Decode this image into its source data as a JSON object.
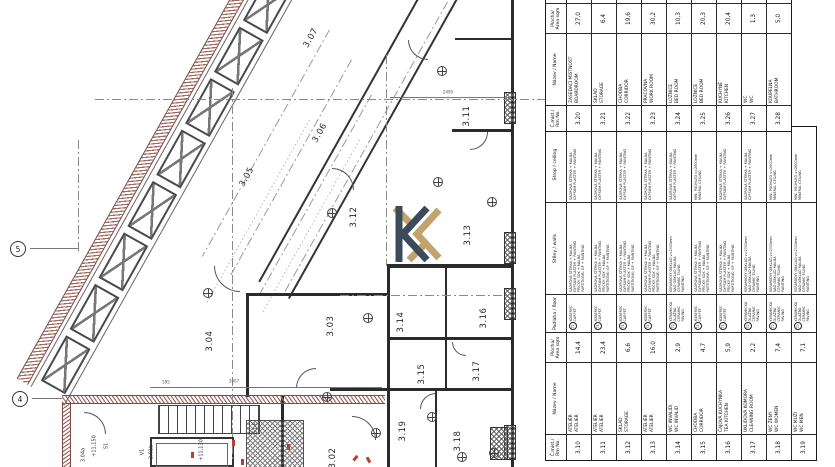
{
  "logo": {
    "navy": "#3c4b59",
    "gold": "#c2a26e"
  },
  "grid_axes": {
    "bubbles": [
      {
        "label": "5"
      },
      {
        "label": "4"
      }
    ]
  },
  "plan": {
    "rooms": [
      {
        "label": "3.02",
        "x": 333,
        "y": 458,
        "rot": -90
      },
      {
        "label": "3.03",
        "x": 331,
        "y": 326,
        "rot": -90
      },
      {
        "label": "3.04",
        "x": 210,
        "y": 341,
        "rot": -90
      },
      {
        "label": "3.05",
        "x": 247,
        "y": 177,
        "rot": -61
      },
      {
        "label": "3.06",
        "x": 320,
        "y": 133,
        "rot": -61
      },
      {
        "label": "3.07",
        "x": 311,
        "y": 38,
        "rot": -61
      },
      {
        "label": "3.11",
        "x": 467,
        "y": 116,
        "rot": -90
      },
      {
        "label": "3.12",
        "x": 354,
        "y": 217,
        "rot": -90
      },
      {
        "label": "3.13",
        "x": 468,
        "y": 235,
        "rot": -90
      },
      {
        "label": "3.14",
        "x": 401,
        "y": 322,
        "rot": -90
      },
      {
        "label": "3.15",
        "x": 422,
        "y": 374,
        "rot": -90
      },
      {
        "label": "3.16",
        "x": 484,
        "y": 318,
        "rot": -90
      },
      {
        "label": "3.17",
        "x": 477,
        "y": 371,
        "rot": -90
      },
      {
        "label": "3.18",
        "x": 458,
        "y": 441,
        "rot": -90
      },
      {
        "label": "3.19",
        "x": 403,
        "y": 431,
        "rot": -90
      }
    ],
    "annotations": [
      {
        "label": "S1",
        "x": 107,
        "y": 446,
        "rot": -90
      },
      {
        "label": "+11,150",
        "x": 95,
        "y": 446,
        "rot": -90
      },
      {
        "label": "V1",
        "x": 143,
        "y": 452,
        "rot": -90
      },
      {
        "label": "3.01b",
        "x": 152,
        "y": 452,
        "rot": -90
      },
      {
        "label": "+11,130",
        "x": 202,
        "y": 450,
        "rot": -90
      },
      {
        "label": "S1-P",
        "x": 256,
        "y": 428,
        "rot": -90
      },
      {
        "label": "3.04a",
        "x": 84,
        "y": 455,
        "rot": -90
      }
    ],
    "dimensions": [
      {
        "label": "595",
        "x": 166,
        "y": 382
      },
      {
        "label": "3007",
        "x": 234,
        "y": 381
      },
      {
        "label": "2490",
        "x": 448,
        "y": 92
      }
    ]
  },
  "schedule": {
    "headers": {
      "rm": "Č.míst./\nRm No.",
      "name": "Název / Name",
      "area": "Plocha/\nArea sqm",
      "floor": "Podlaha / floor",
      "walls": "Stěny / walls",
      "ceil": "Strop / ceiling",
      "sliver": ""
    },
    "table1": {
      "rooms": [
        {
          "no": "3.10",
          "cz": "ATELIÉR",
          "en": "ATELIER",
          "area": "14,4",
          "floor": {
            "sym": "T1",
            "cz": "KOBEREC",
            "en": "CARPET"
          },
          "walls": [
            "SÁDROVÁ STĚRKA + MALBA",
            "GYPSUM PLASTER + PAINTING",
            "PŘÍČKY: SDK + MALBA",
            "PARTITIONS: GP + PAINTING"
          ],
          "ceil": [
            "SÁDROVÁ STĚRKA + MALBA",
            "GYPSUM PLASTER + PAINTING"
          ]
        },
        {
          "no": "3.11",
          "cz": "ATELIÉR",
          "en": "ATELIER",
          "area": "23,4",
          "floor": {
            "sym": "T1",
            "cz": "KOBEREC",
            "en": "CARPET"
          },
          "walls": [
            "SÁDROVÁ STĚRKA + MALBA",
            "GYPSUM PLASTER + PAINTING",
            "PŘÍČKY: SDK + MALBA",
            "PARTITIONS: GP + PAINTING"
          ],
          "ceil": [
            "SÁDROVÁ STĚRKA + MALBA",
            "GYPSUM PLASTER + PAINTING"
          ]
        },
        {
          "no": "3.12",
          "cz": "SKLAD",
          "en": "STORAGE",
          "area": "6,6",
          "floor": {
            "sym": "T1",
            "cz": "KOBEREC",
            "en": "CARPET"
          },
          "walls": [
            "SÁDROVÁ STĚRKA + MALBA",
            "GYPSUM PLASTER + PAINTING",
            "PŘÍČKY: SDK + MALBA",
            "PARTITIONS: GP + PAINTING"
          ],
          "ceil": [
            "SÁDROVÁ STĚRKA + MALBA",
            "GYPSUM PLASTER + PAINTING"
          ]
        },
        {
          "no": "3.13",
          "cz": "ATELIÉR",
          "en": "ATELIER",
          "area": "16,0",
          "floor": {
            "sym": "T1",
            "cz": "KOBEREC",
            "en": "CARPET"
          },
          "walls": [
            "SÁDROVÁ STĚRKA + MALBA",
            "GYPSUM PLASTER + PAINTING",
            "PŘÍČKY: SDK + MALBA",
            "PARTITIONS: GP + PAINTING"
          ],
          "ceil": [
            "SÁDROVÁ STĚRKA + MALBA",
            "GYPSUM PLASTER + PAINTING"
          ]
        },
        {
          "no": "3.14",
          "cz": "WC INVALIDI",
          "en": "WC INVALID",
          "area": "2,9",
          "floor": {
            "sym": "T2",
            "cz": "KERAMICKÁ DLAŽBA",
            "en": "CERAMIC PAVING"
          },
          "walls": [
            "KERAMICKÝ OBKLAD v=2000mm",
            "NAD OBKLAD MALBA",
            "CERAMIC TILING",
            "PAINTING"
          ],
          "ceil": [
            "SÁDROVÁ STĚRKA + MALBA",
            "GYPSUM PLASTER + PAINTING"
          ]
        },
        {
          "no": "3.15",
          "cz": "CHODBA",
          "en": "CORRIDOR",
          "area": "4,7",
          "floor": {
            "sym": "T1",
            "cz": "KOBEREC",
            "en": "CARPET"
          },
          "walls": [
            "SÁDROVÁ STĚRKA + MALBA",
            "GYPSUM PLASTER + PAINTING",
            "PŘÍČKY: SDK + MALBA",
            "PARTITIONS: GP + PAINTING"
          ],
          "ceil": [
            "MIN. PODHLED v=2600mm",
            "MINERAL CEILING"
          ]
        },
        {
          "no": "3.16",
          "cz": "ČAJOVÁ KUCHYŇKA",
          "en": "TEA KITCHEN",
          "area": "5,9",
          "floor": {
            "sym": "T1",
            "cz": "KOBEREC",
            "en": "CARPET"
          },
          "walls": [
            "SÁDROVÁ STĚRKA + MALBA",
            "GYPSUM PLASTER + PAINTING",
            "PŘÍČKY: SDK + MALBA",
            "PARTITIONS: GP + PAINTING"
          ],
          "ceil": [
            "SÁDROVÁ STĚRKA + MALBA",
            "GYPSUM PLASTER + PAINTING"
          ]
        },
        {
          "no": "3.17",
          "cz": "ÚKLIDOVÁ KOMORA",
          "en": "CLEANING ROOM",
          "area": "2,2",
          "floor": {
            "sym": "T2",
            "cz": "KERAMICKÁ DLAŽBA",
            "en": "CERAMIC PAVING"
          },
          "walls": [
            "KERAMICKÝ OBKLAD v=2000mm",
            "NAD OBKLAD MALBA",
            "CERAMIC TILING",
            "PAINTING"
          ],
          "ceil": [
            "SÁDROVÁ STĚRKA + MALBA",
            "GYPSUM PLASTER + PAINTING"
          ]
        },
        {
          "no": "3.18",
          "cz": "WC ŽENY",
          "en": "WC WOMEN",
          "area": "7,4",
          "floor": {
            "sym": "T2",
            "cz": "KERAMICKÁ DLAŽBA",
            "en": "CERAMIC PAVING"
          },
          "walls": [
            "KERAMICKÝ OBKLAD v=2000mm",
            "NAD OBKLAD MALBA",
            "CERAMIC TILING",
            "PAINTING"
          ],
          "ceil": [
            "MIN. PODHLED v=2600mm",
            "MINERAL CEILING"
          ]
        },
        {
          "no": "3.19",
          "cz": "WC MUŽI",
          "en": "WC MEN",
          "area": "7,1",
          "floor": {
            "sym": "T2",
            "cz": "KERAMICKÁ DLAŽBA",
            "en": "CERAMIC PAVING"
          },
          "walls": [
            "KERAMICKÝ OBKLAD v=2000mm",
            "NAD OBKLAD MALBA",
            "CERAMIC TILING",
            "PAINTING"
          ],
          "ceil": [
            "MIN. PODHLED v=2600mm",
            "MINERAL CEILING"
          ]
        }
      ]
    },
    "table2": {
      "rooms": [
        {
          "no": "3.20",
          "cz": "ZASEDACÍ MÍSTNOST",
          "en": "BOARDROOM",
          "area": "27,0"
        },
        {
          "no": "3.21",
          "cz": "SKLAD",
          "en": "STORAGE",
          "area": "6,4"
        },
        {
          "no": "3.22",
          "cz": "CHODBA",
          "en": "CORRIDOR",
          "area": "19,6"
        },
        {
          "no": "3.23",
          "cz": "PRACOVNA",
          "en": "WORK ROOM",
          "area": "30,2"
        },
        {
          "no": "3.24",
          "cz": "LOŽNICE",
          "en": "BED ROOM",
          "area": "10,3"
        },
        {
          "no": "3.25",
          "cz": "LOŽNICE",
          "en": "BED ROOM",
          "area": "20,3"
        },
        {
          "no": "3.26",
          "cz": "KUCHYNĚ",
          "en": "KITCHEN",
          "area": "20,4"
        },
        {
          "no": "3.27",
          "cz": "WC",
          "en": "WC",
          "area": "1,3"
        },
        {
          "no": "3.28",
          "cz": "KOUPELNA",
          "en": "BATHROOM",
          "area": "5,0"
        }
      ]
    }
  }
}
